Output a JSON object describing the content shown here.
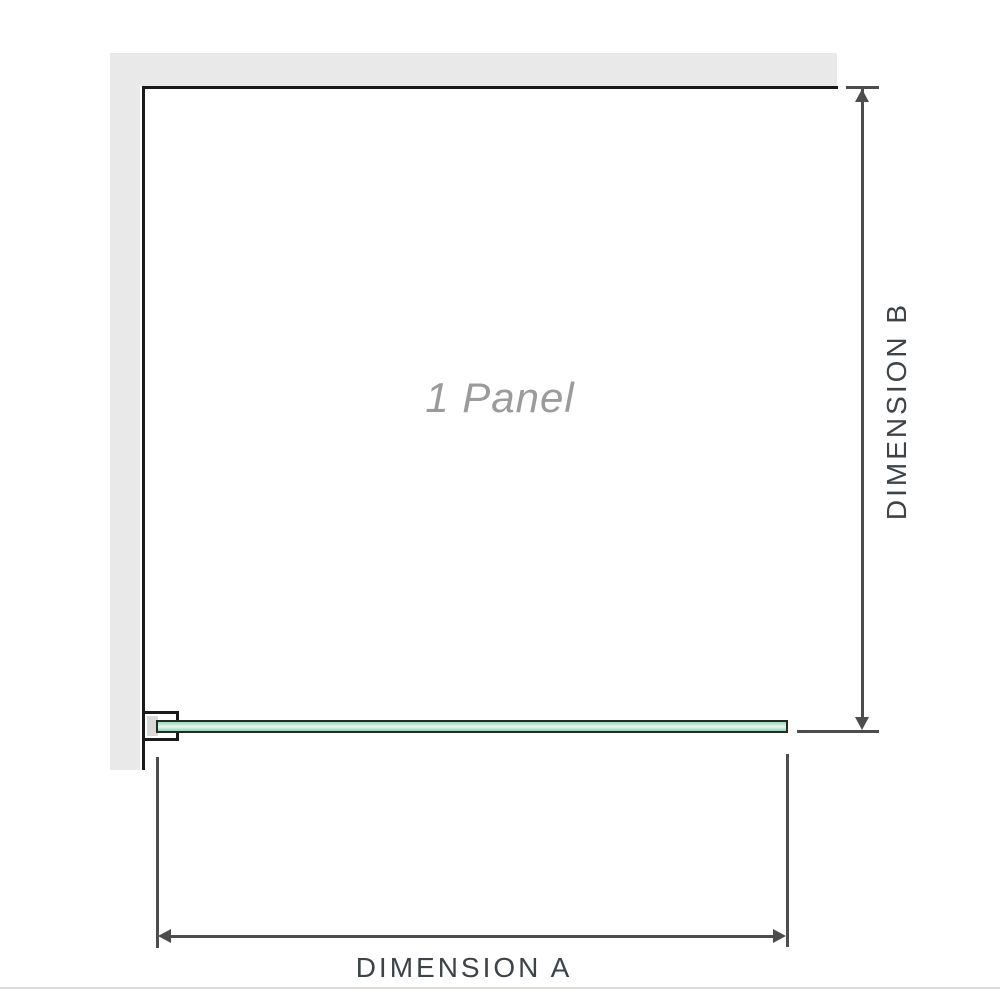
{
  "diagram": {
    "watermark": "1 Panel",
    "dimension_a_label": "DIMENSION A",
    "dimension_b_label": "DIMENSION B"
  },
  "colors": {
    "wall_fill": "#e9e9e9",
    "wall_edge": "#1a1a1a",
    "glass_fill": "#a6dbc0",
    "glass_fill_dark": "#9dd5b9",
    "glass_highlight": "#eaf7f0",
    "glass_border": "#1f2d24",
    "dimension_line": "#4d4d4d",
    "label_text": "#3e4347",
    "watermark_text": "#9b9b9b",
    "baseline": "#dcdad4"
  }
}
